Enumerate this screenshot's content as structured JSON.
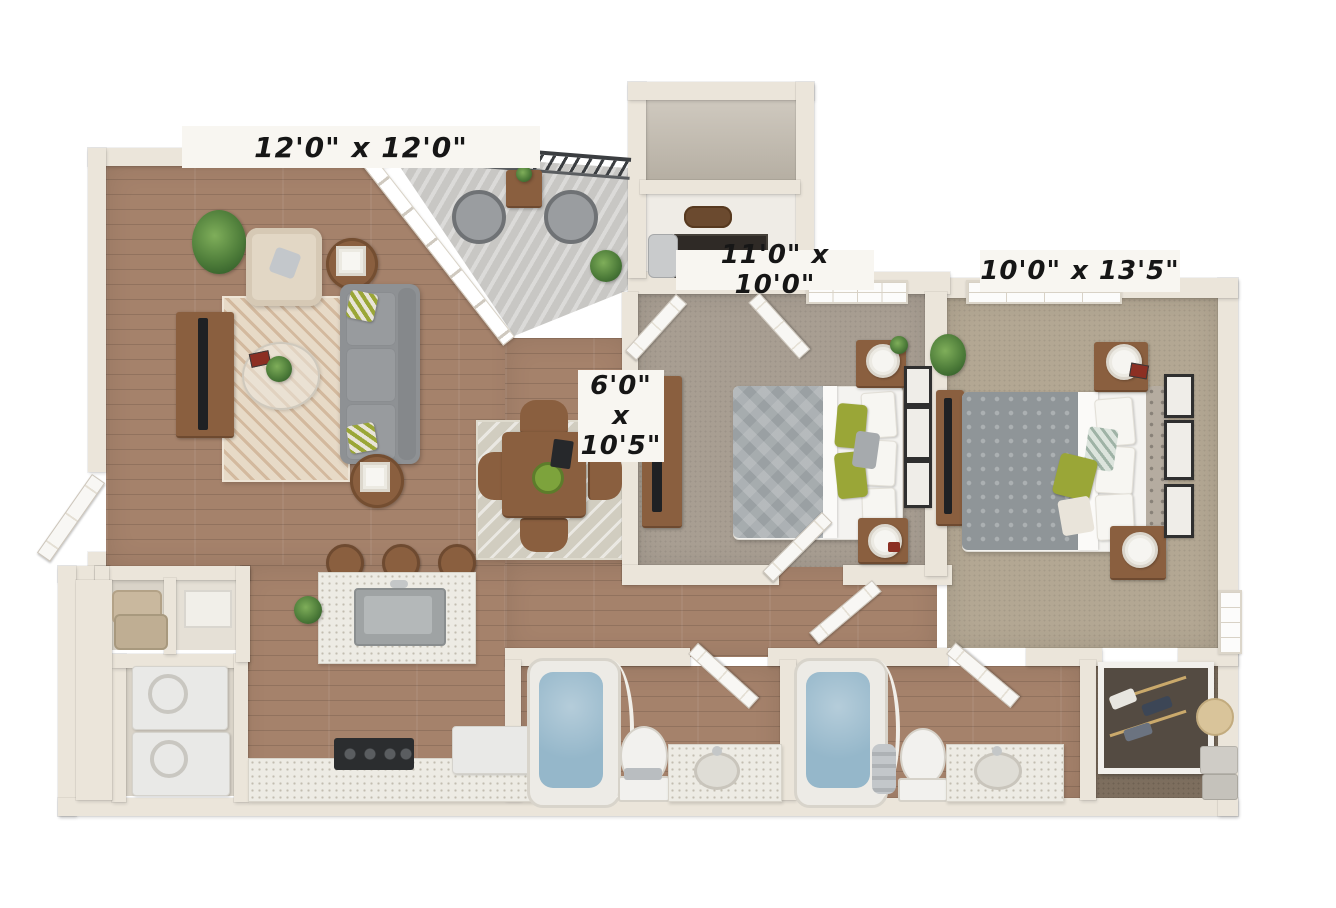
{
  "floor_plan": {
    "dimension_labels": {
      "living_room": "12'0\" x 12'0\"",
      "bedroom_1": "11'0\" x 10'0\"",
      "bedroom_2": "10'0\" x 13'5\"",
      "dining_nook": {
        "width": "6'0\"",
        "separator": "x",
        "length": "10'5\""
      }
    },
    "colors": {
      "background": "#ffffff",
      "wall": "#ebe5da",
      "wall_edge": "#d9d1c3",
      "wood_floor": "#a5826b",
      "wood_plank_line": "#93705b",
      "carpet_bedroom_1": "#a89e92",
      "carpet_bedroom_2": "#b3a793",
      "carpet_closet": "#7d6e5e",
      "balcony_concrete": "#c8c7c4",
      "living_rug": "#e7dac7",
      "living_rug_stripe": "#d3b99e",
      "dining_rug": "#d1cdc0",
      "sofa_gray": "#8e9194",
      "armchair_beige": "#e2d7c5",
      "accent_green": "#9aa637",
      "plant_green": "#4e7d3a",
      "tub_water_blue": "#95b7ca",
      "counter_speckle": "#edebe4",
      "appliance_white": "#e9e9e7",
      "furniture_wood": "#8a5f3f",
      "railing_black": "#3b3e41",
      "tv_black": "#1f2124",
      "label_bg": "#f8f6f1",
      "label_text": "#161616"
    }
  }
}
